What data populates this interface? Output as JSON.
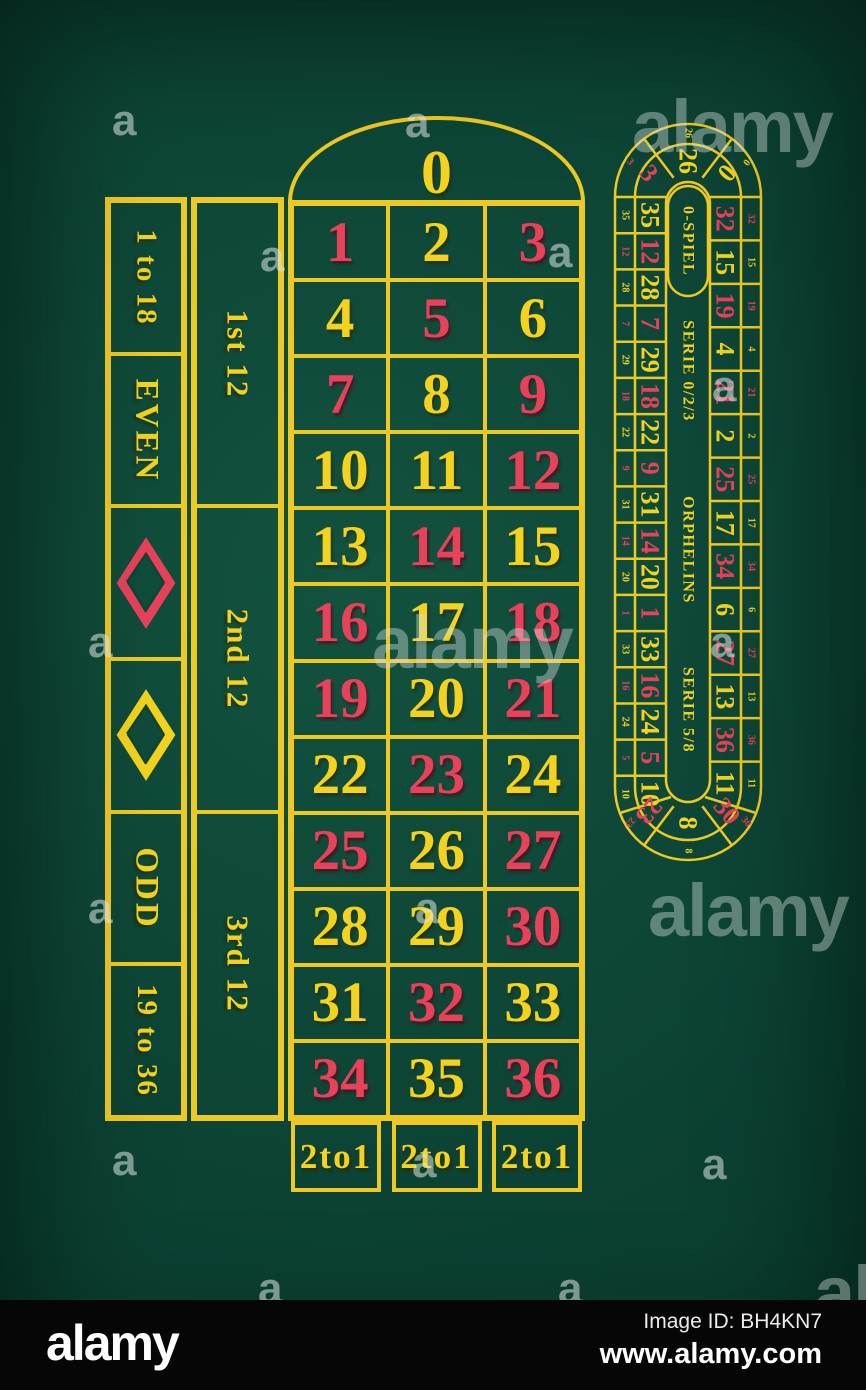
{
  "colors": {
    "felt": "#0d4536",
    "line": "#efc923",
    "yellow": "#f3d31f",
    "red": "#e7425a"
  },
  "layout_grid": {
    "zero": {
      "value": "0",
      "color": "yellow"
    },
    "rows": [
      [
        {
          "value": "1",
          "color": "red"
        },
        {
          "value": "2",
          "color": "yellow"
        },
        {
          "value": "3",
          "color": "red"
        }
      ],
      [
        {
          "value": "4",
          "color": "yellow"
        },
        {
          "value": "5",
          "color": "red"
        },
        {
          "value": "6",
          "color": "yellow"
        }
      ],
      [
        {
          "value": "7",
          "color": "red"
        },
        {
          "value": "8",
          "color": "yellow"
        },
        {
          "value": "9",
          "color": "red"
        }
      ],
      [
        {
          "value": "10",
          "color": "yellow"
        },
        {
          "value": "11",
          "color": "yellow"
        },
        {
          "value": "12",
          "color": "red"
        }
      ],
      [
        {
          "value": "13",
          "color": "yellow"
        },
        {
          "value": "14",
          "color": "red"
        },
        {
          "value": "15",
          "color": "yellow"
        }
      ],
      [
        {
          "value": "16",
          "color": "red"
        },
        {
          "value": "17",
          "color": "yellow"
        },
        {
          "value": "18",
          "color": "red"
        }
      ],
      [
        {
          "value": "19",
          "color": "red"
        },
        {
          "value": "20",
          "color": "yellow"
        },
        {
          "value": "21",
          "color": "red"
        }
      ],
      [
        {
          "value": "22",
          "color": "yellow"
        },
        {
          "value": "23",
          "color": "red"
        },
        {
          "value": "24",
          "color": "yellow"
        }
      ],
      [
        {
          "value": "25",
          "color": "red"
        },
        {
          "value": "26",
          "color": "yellow"
        },
        {
          "value": "27",
          "color": "red"
        }
      ],
      [
        {
          "value": "28",
          "color": "yellow"
        },
        {
          "value": "29",
          "color": "yellow"
        },
        {
          "value": "30",
          "color": "red"
        }
      ],
      [
        {
          "value": "31",
          "color": "yellow"
        },
        {
          "value": "32",
          "color": "red"
        },
        {
          "value": "33",
          "color": "yellow"
        }
      ],
      [
        {
          "value": "34",
          "color": "red"
        },
        {
          "value": "35",
          "color": "yellow"
        },
        {
          "value": "36",
          "color": "red"
        }
      ]
    ],
    "bottom_row": [
      "2to1",
      "2to1",
      "2to1"
    ],
    "outside_bets": [
      {
        "type": "text",
        "label": "1 to 18",
        "size": "normal"
      },
      {
        "type": "text",
        "label": "EVEN",
        "size": "big"
      },
      {
        "type": "diamond",
        "color": "red"
      },
      {
        "type": "diamond",
        "color": "yellow"
      },
      {
        "type": "text",
        "label": "ODD",
        "size": "big"
      },
      {
        "type": "text",
        "label": "19 to 36",
        "size": "normal"
      }
    ],
    "dozens": [
      "1st 12",
      "2nd 12",
      "3rd 12"
    ]
  },
  "racetrack": {
    "center_labels": [
      "0-SPIEL",
      "SERIE 0/2/3",
      "ORPHELINS",
      "SERIE 5/8"
    ],
    "top_arc": [
      {
        "value": "3",
        "color": "red"
      },
      {
        "value": "26",
        "color": "yellow"
      },
      {
        "value": "0",
        "color": "yellow"
      }
    ],
    "left_column": [
      {
        "value": "35",
        "color": "yellow"
      },
      {
        "value": "12",
        "color": "red"
      },
      {
        "value": "28",
        "color": "yellow"
      },
      {
        "value": "7",
        "color": "red"
      },
      {
        "value": "29",
        "color": "yellow"
      },
      {
        "value": "18",
        "color": "red"
      },
      {
        "value": "22",
        "color": "yellow"
      },
      {
        "value": "9",
        "color": "red"
      },
      {
        "value": "31",
        "color": "yellow"
      },
      {
        "value": "14",
        "color": "red"
      },
      {
        "value": "20",
        "color": "yellow"
      },
      {
        "value": "1",
        "color": "red"
      },
      {
        "value": "33",
        "color": "yellow"
      },
      {
        "value": "16",
        "color": "red"
      },
      {
        "value": "24",
        "color": "yellow"
      },
      {
        "value": "5",
        "color": "red"
      },
      {
        "value": "10",
        "color": "yellow"
      }
    ],
    "right_column": [
      {
        "value": "32",
        "color": "red"
      },
      {
        "value": "15",
        "color": "yellow"
      },
      {
        "value": "19",
        "color": "red"
      },
      {
        "value": "4",
        "color": "yellow"
      },
      {
        "value": "21",
        "color": "red"
      },
      {
        "value": "2",
        "color": "yellow"
      },
      {
        "value": "25",
        "color": "red"
      },
      {
        "value": "17",
        "color": "yellow"
      },
      {
        "value": "34",
        "color": "red"
      },
      {
        "value": "6",
        "color": "yellow"
      },
      {
        "value": "27",
        "color": "red"
      },
      {
        "value": "13",
        "color": "yellow"
      },
      {
        "value": "36",
        "color": "red"
      },
      {
        "value": "11",
        "color": "yellow"
      }
    ],
    "bottom_arc": [
      {
        "value": "23",
        "color": "red"
      },
      {
        "value": "8",
        "color": "yellow"
      },
      {
        "value": "30",
        "color": "red"
      }
    ]
  },
  "watermarks": {
    "brand": "alamy",
    "letter": "a",
    "big": [
      {
        "x": 632,
        "y": 84
      },
      {
        "x": 372,
        "y": 600
      },
      {
        "x": 648,
        "y": 868
      },
      {
        "x": 814,
        "y": 1250
      }
    ],
    "small": [
      {
        "x": 405,
        "y": 98
      },
      {
        "x": 112,
        "y": 96
      },
      {
        "x": 548,
        "y": 228
      },
      {
        "x": 260,
        "y": 232
      },
      {
        "x": 88,
        "y": 618
      },
      {
        "x": 712,
        "y": 362
      },
      {
        "x": 710,
        "y": 618
      },
      {
        "x": 88,
        "y": 884
      },
      {
        "x": 415,
        "y": 884
      },
      {
        "x": 112,
        "y": 1136
      },
      {
        "x": 412,
        "y": 1138
      },
      {
        "x": 702,
        "y": 1140
      },
      {
        "x": 558,
        "y": 1264
      },
      {
        "x": 258,
        "y": 1264
      }
    ]
  },
  "footer": {
    "logo": "alamy",
    "image_id": "Image ID: BH4KN7",
    "url": "www.alamy.com"
  }
}
